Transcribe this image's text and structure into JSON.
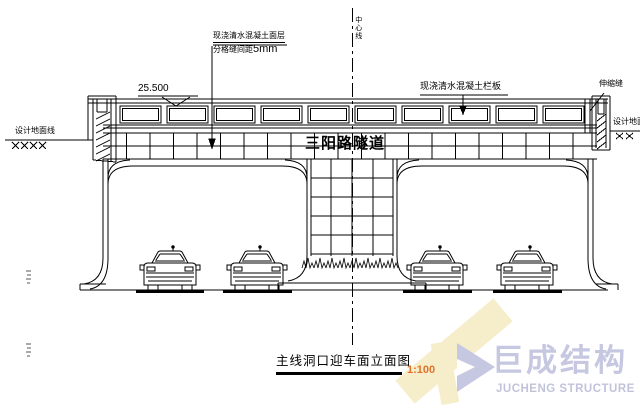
{
  "labels": {
    "centerline": "中心线",
    "surface_note_line1": "现浇清水混凝土面层",
    "surface_note_line2_cn": "分格缝间距",
    "surface_note_line2_val": "5mm",
    "elevation": "25.500",
    "railing_note": "现浇清水混凝土栏板",
    "expansion_joint": "伸缩缝",
    "ground_line_left": "设计地面线",
    "ground_line_right": "设计地面线",
    "tunnel_name": "三阳路隧道"
  },
  "title_block": {
    "title": "主线洞口迎车面立面图",
    "scale": "1:100"
  },
  "logo": {
    "name_cn": "巨成结构",
    "name_en": "JUCHENG STRUCTURE"
  },
  "colors": {
    "line": "#000000",
    "scale_text": "#e0732a",
    "watermark": "#f6eecb",
    "logo_primary": "#c6c7e1",
    "logo_secondary": "#c0c3db"
  }
}
